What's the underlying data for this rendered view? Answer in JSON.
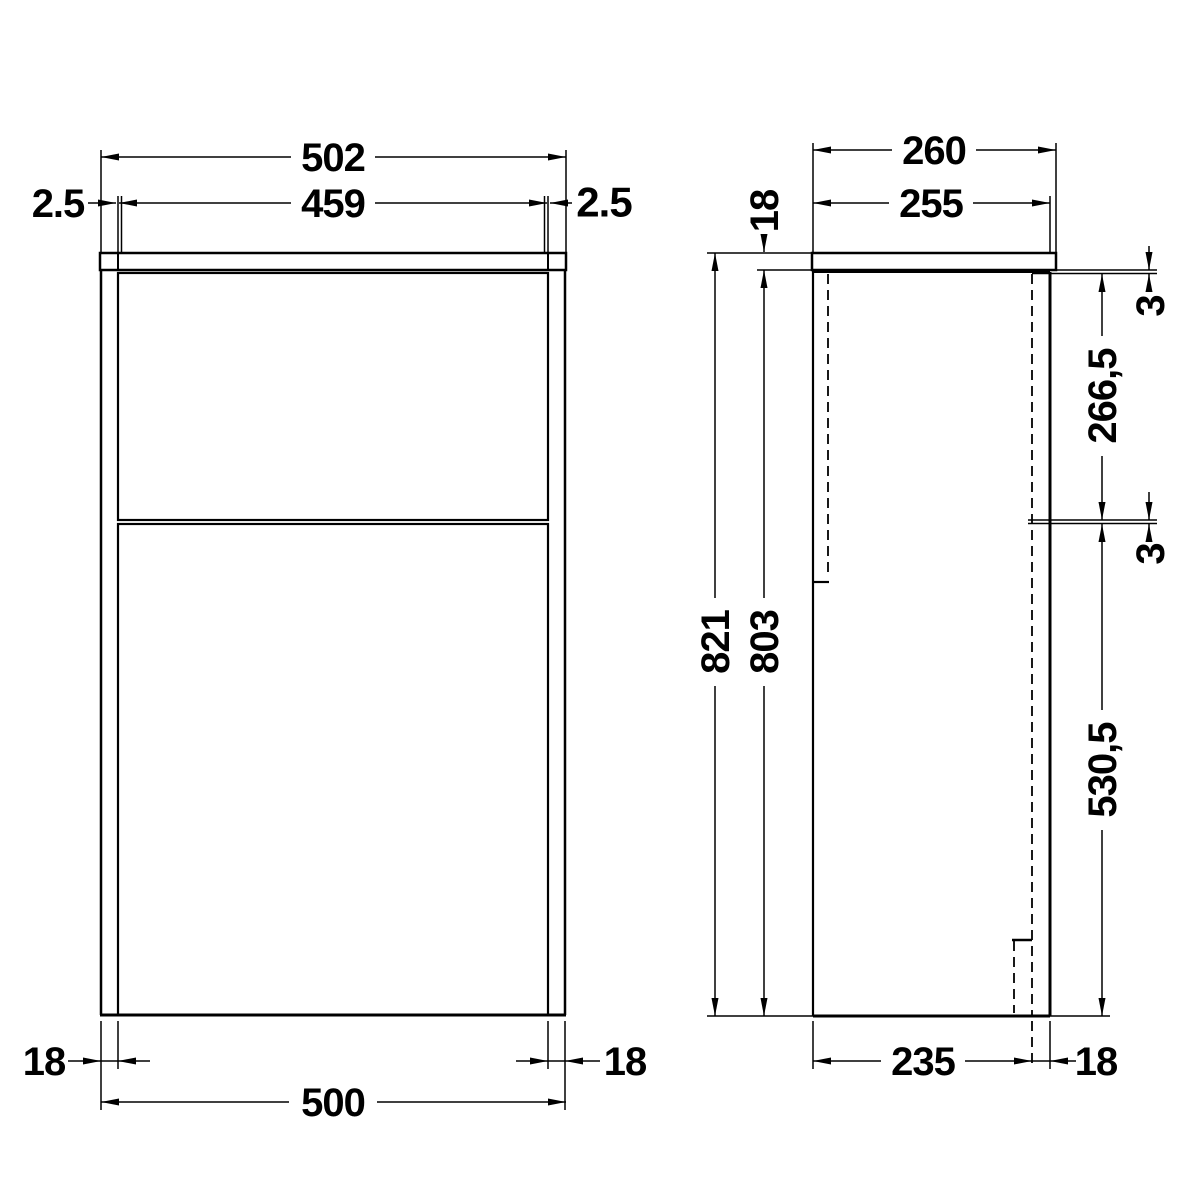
{
  "drawing": {
    "type": "technical-dimension-drawing",
    "colors": {
      "line": "#000000",
      "background": "#ffffff"
    },
    "front_view": {
      "worktop_width": "502",
      "door_width": "459",
      "door_gap_left": "2.5",
      "door_gap_right": "2.5",
      "side_panel_thickness_left": "18",
      "side_panel_thickness_right": "18",
      "carcass_width": "500"
    },
    "side_view": {
      "worktop_depth": "260",
      "carcass_depth": "255",
      "worktop_thickness": "18",
      "overall_height": "821",
      "carcass_height": "803",
      "top_rail_thickness": "3",
      "upper_section_height": "266,5",
      "mid_rail_thickness": "3",
      "lower_section_height": "530,5",
      "internal_depth": "235",
      "back_panel_thickness": "18"
    }
  }
}
